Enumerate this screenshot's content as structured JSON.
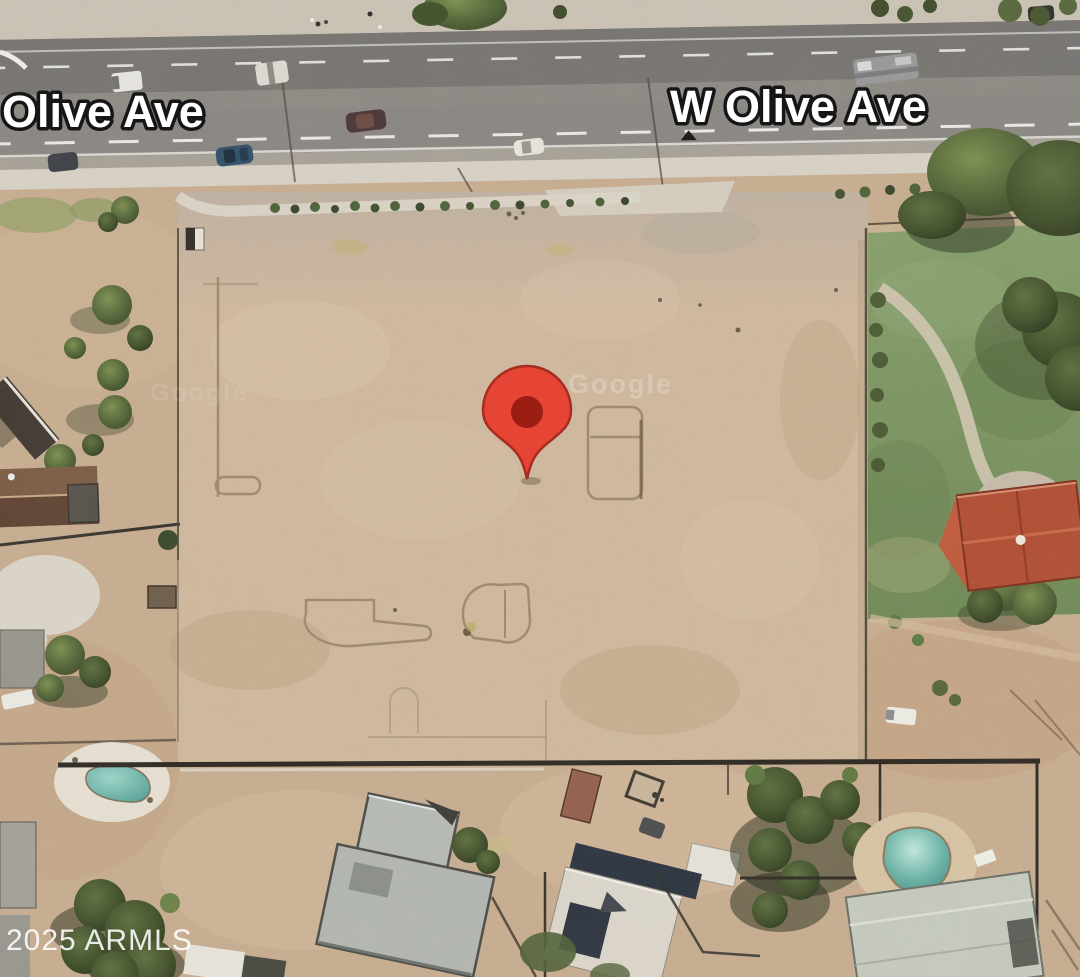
{
  "map_view": {
    "type": "satellite-imagery",
    "street_labels": [
      {
        "text": "Olive Ave"
      },
      {
        "text": "W Olive Ave"
      }
    ],
    "label_style": {
      "fill": "#ffffff",
      "outline": "#161616"
    },
    "copyright_watermark": "2025 ARMLS",
    "imagery_watermark": "Google",
    "marker": {
      "shape": "location-pin",
      "fill": "#e64435",
      "inner_dot": "#9c1d12",
      "outline": "#a62d20",
      "x": 527,
      "y": 479
    },
    "palette": {
      "vacant_lot_dirt": "#d0b99f",
      "surrounding_dirt": "#c6ab8d",
      "road_asphalt": "#7e7c79",
      "road_concrete_gutter": "#a7a299",
      "sidewalk": "#d9d3c7",
      "lawn": "#7e9763",
      "pool_water": "#52a09a",
      "red_roof": "#b14e33",
      "gray_roof": "#b5b9b5",
      "tree_canopy": "#4e5e36"
    }
  }
}
